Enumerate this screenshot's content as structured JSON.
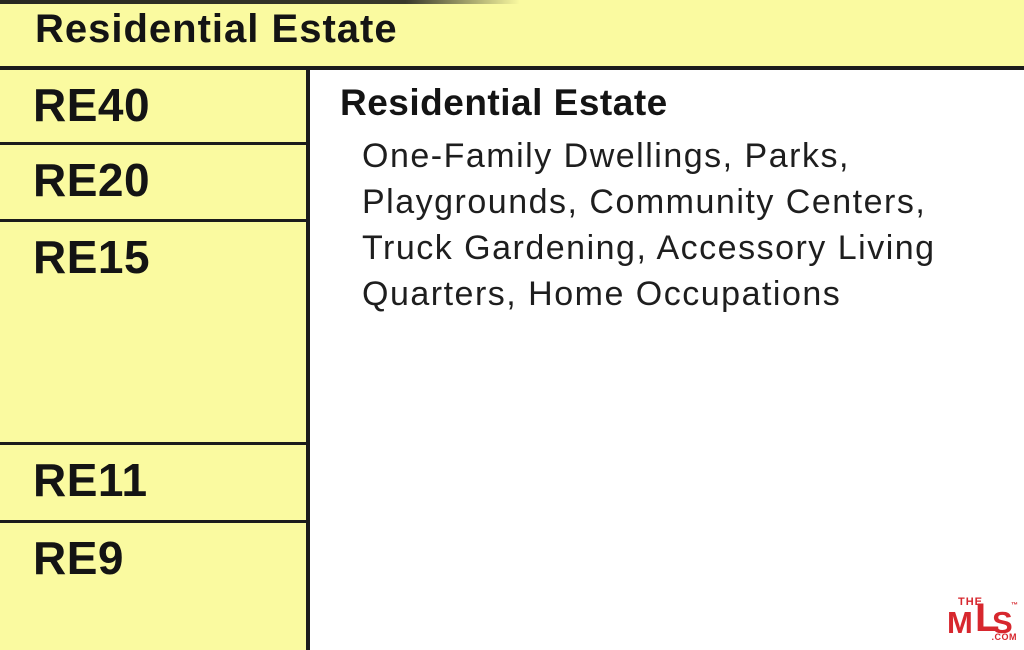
{
  "palette": {
    "cell_yellow": "#FAFAA0",
    "line_black": "#1B1B1B",
    "text_black": "#141414",
    "logo_red": "#D7272E",
    "background_white": "#FFFFFF"
  },
  "header": {
    "title": "Residential Estate"
  },
  "sidebar": {
    "rows": [
      {
        "label": "RE40"
      },
      {
        "label": "RE20"
      },
      {
        "label": "RE15"
      },
      {
        "label": "RE11"
      },
      {
        "label": "RE9"
      }
    ]
  },
  "content": {
    "heading": "Residential Estate",
    "description": "One-Family Dwellings, Parks,\nPlaygrounds, Community Centers,\nTruck Gardening, Accessory Living\nQuarters, Home Occupations"
  },
  "logo": {
    "the": "THE",
    "m": "M",
    "l": "L",
    "s": "S",
    "tm": "™",
    "com": ".COM"
  }
}
